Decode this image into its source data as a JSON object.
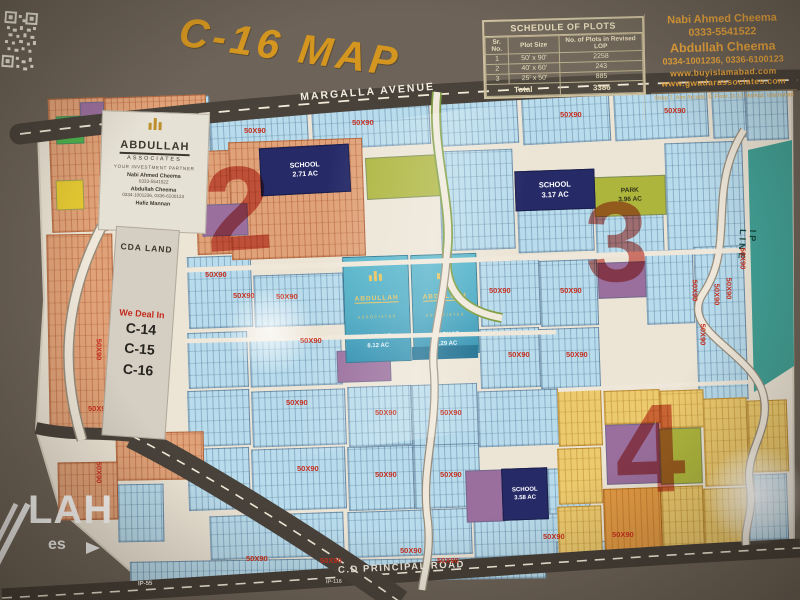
{
  "title": "C-16 MAP",
  "roads": {
    "margalla": "MARGALLA AVENUE",
    "cd_principal": "C.D PRINCIPAL ROAD",
    "ip55": "IP-55",
    "ip116": "IP-116",
    "ip_line": "IP LINE"
  },
  "schedule": {
    "title": "SCHEDULE OF PLOTS",
    "columns": [
      "Sr. No.",
      "Plot Size",
      "No. of Plots in Revised LOP"
    ],
    "rows": [
      [
        "1",
        "50' x 90'",
        "2258"
      ],
      [
        "2",
        "40' x 60'",
        "243"
      ],
      [
        "3",
        "25' x 50'",
        "885"
      ]
    ],
    "total_label": "Total",
    "total_value": "3386"
  },
  "contact": {
    "name1": "Nabi Ahmed Cheema",
    "phone1": "0333-5541522",
    "name2": "Abdullah Cheema",
    "phone2": "0334-1001236, 0336-6100123",
    "web1": "www.buyislamabad.com",
    "web2": "www.gwadarassociates.com",
    "address": "Shop 7, Aim Arcade, G Floor, D-12 Markaz, Islamabad"
  },
  "logo_box": {
    "brand": "ABDULLAH",
    "type": "ASSOCIATES",
    "tagline": "YOUR INVESTMENT PARTNER",
    "agents": [
      {
        "name": "Nabi Ahmed Cheema",
        "phone": "0333-5541522"
      },
      {
        "name": "Abdullah Cheema",
        "phone": "0334-1001236, 0336-6100123"
      },
      {
        "name": "Hafiz Mannan",
        "phone": ""
      }
    ]
  },
  "left_panel": {
    "cda": "CDA LAND",
    "deal_heading": "We Deal In",
    "sectors": [
      "C-14",
      "C-15",
      "C-16"
    ]
  },
  "blocks": {
    "school_label": "SCHOOL",
    "park_label": "PARK",
    "school1_area": "2.71 AC",
    "school2_area": "3.17 AC",
    "park2_area": "3.96 AC",
    "school3_area": "3.58 AC",
    "markaz_label": "MARKAZ",
    "markaz1_area": "8.12 AC",
    "markaz2_area": "9.29 AC"
  },
  "markaz_logo": {
    "brand": "ABDULLAH",
    "type": "ASSOCIATES"
  },
  "plots": {
    "size_label": "50X90"
  },
  "sector_numbers": [
    "2",
    "3",
    "4"
  ],
  "watermark": {
    "text": "LAH",
    "sub": "es"
  }
}
